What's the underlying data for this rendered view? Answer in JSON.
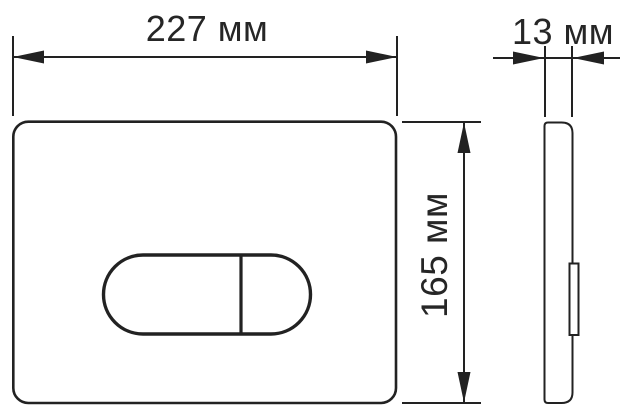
{
  "diagram": {
    "type": "technical-drawing",
    "dimensions": {
      "width": {
        "label": "227 мм",
        "value": 227,
        "unit": "мм"
      },
      "height": {
        "label": "165 мм",
        "value": 165,
        "unit": "мм"
      },
      "depth": {
        "label": "13 мм",
        "value": 13,
        "unit": "мм"
      }
    },
    "colors": {
      "line": "#222222",
      "text": "#262626",
      "bg": "#ffffff"
    }
  }
}
